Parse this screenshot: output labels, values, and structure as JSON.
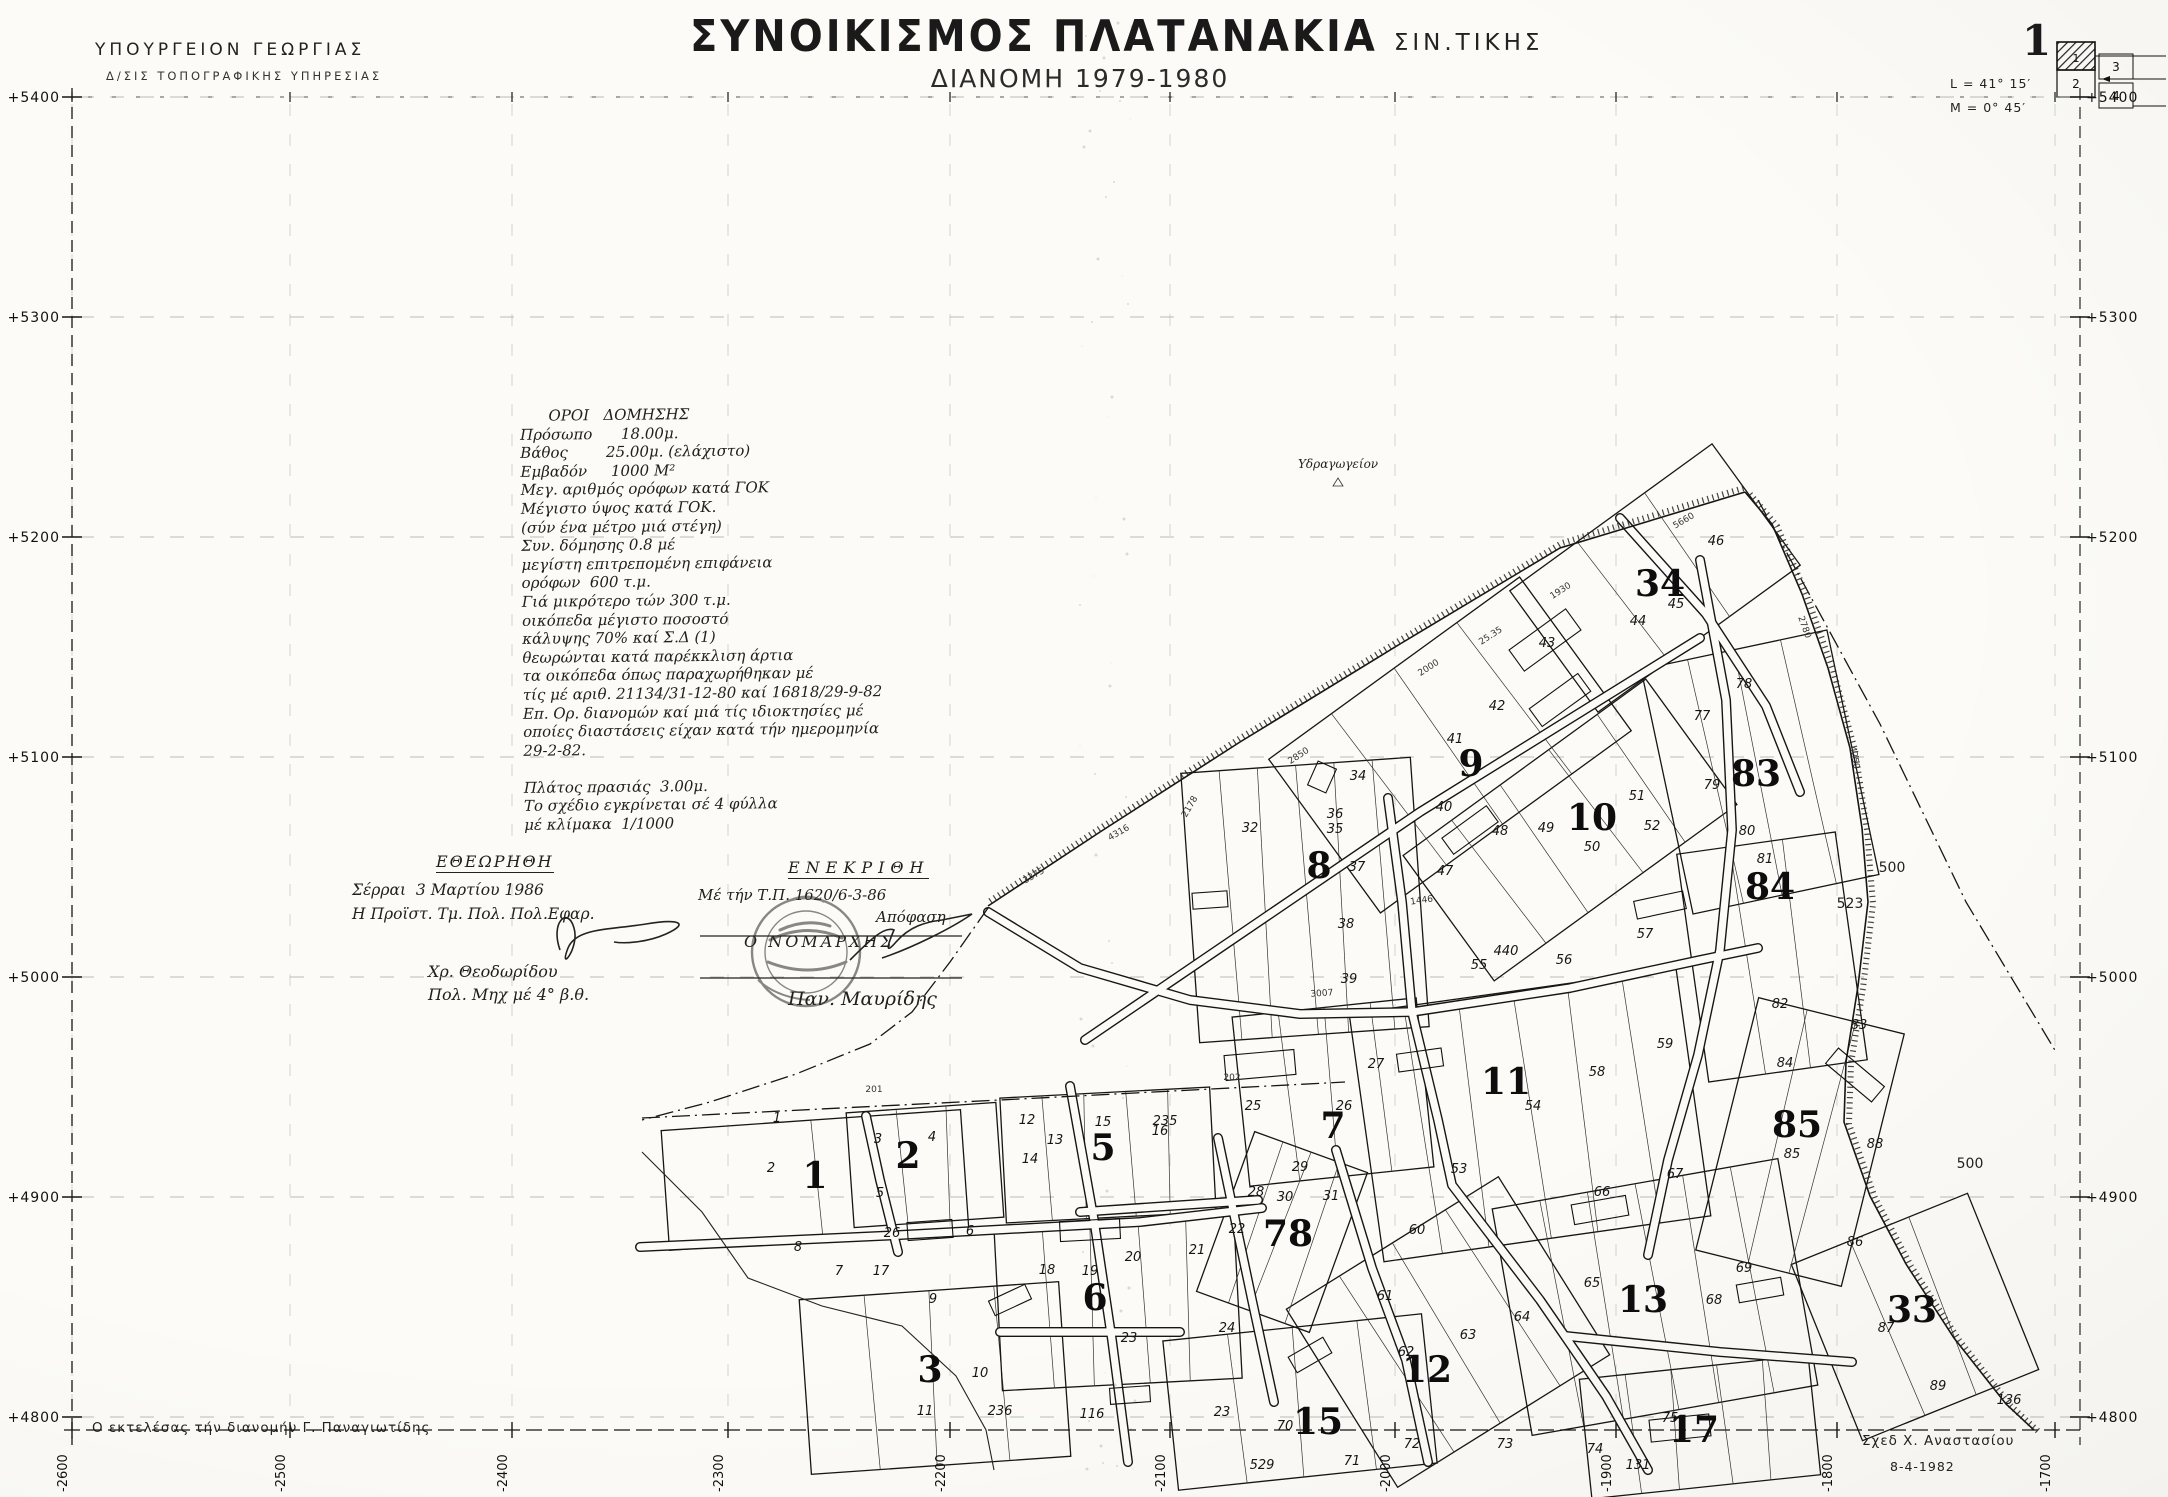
{
  "header": {
    "ministry_line1": "ΥΠΟΥΡΓΕΙΟΝ  ΓΕΩΡΓΙΑΣ",
    "ministry_line2": "Δ/ΣΙΣ  ΤΟΠΟΓΡΑΦΙΚΗΣ  ΥΠΗΡΕΣΙΑΣ",
    "title_main": "ΣΥΝΟΙΚΙΣΜΟΣ  ΠΛΑΤΑΝΑΚΙΑ",
    "title_area": "ΣΙΝ.ΤΙΚΗΣ",
    "subtitle": "ΔΙΑΝΟΜΗ  1979-1980"
  },
  "sheet_index": {
    "sheet_number": "1",
    "latitude": "L = 41° 15′",
    "meridian": "M =  0° 45′",
    "cells": [
      "1",
      "2",
      "3",
      "4"
    ]
  },
  "grid": {
    "row_labels": [
      "+5400",
      "+5300",
      "+5200",
      "+5100",
      "+5000",
      "+4900",
      "+4800"
    ],
    "col_labels": [
      "-2600",
      "-2500",
      "-2400",
      "-2300",
      "-2200",
      "-2100",
      "-2000",
      "-1900",
      "-1800",
      "-1700"
    ]
  },
  "notes": {
    "lines": [
      "      ΟΡΟΙ   ΔΟΜΗΣΗΣ",
      "Πρόσωπο      18.00μ.",
      "Βάθος        25.00μ. (ελάχιστο)",
      "Εμβαδόν     1000 Μ²",
      "Μεγ. αριθμός ορόφων κατά ΓΟΚ",
      "Μέγιστο ύψος κατά ΓΟΚ.",
      "(σύν ένα μέτρο μιά στέγη)",
      "Συν. δόμησης 0.8 μέ",
      "μεγίστη επιτρεπομένη επιφάνεια",
      "ορόφων  600 τ.μ.",
      "Γιά μικρότερο τών 300 τ.μ.",
      "οικόπεδα μέγιστο ποσοστό",
      "κάλυψης 70% καί Σ.Δ (1)",
      "θεωρώνται κατά παρέκκλιση άρτια",
      "τα οικόπεδα όπως παραχωρήθηκαν μέ",
      "τίς μέ αριθ. 21134/31-12-80 καί 16818/29-9-82",
      "Επ. Ορ. διανομών καί μιά τίς ιδιοκτησίες μέ",
      "οποίες διαστάσεις είχαν κατά τήν ημερομηνία",
      "29-2-82.",
      "",
      "Πλάτος πρασιάς  3.00μ.",
      "Το σχέδιο εγκρίνεται σέ 4 φύλλα",
      "μέ κλίμακα  1/1000"
    ]
  },
  "approval_left": {
    "title": "ΕΘΕΩΡΗΘΗ",
    "lines": [
      "Σέρραι  3 Μαρτίου 1986",
      "Η Προϊστ. Τμ. Πολ. Πολ.Εφαρ."
    ],
    "signer": "Χρ. Θεοδωρίδου",
    "signer_title": "Πολ. Μηχ μέ 4° β.θ."
  },
  "approval_right": {
    "title": "ΕΝΕΚΡΙΘΗ",
    "line1": "Μέ τήν Τ.Π. 1620/6-3-86",
    "line2": "Απόφαση",
    "line3": "Ο ΝΟΜΑΡΧΗΣ",
    "signer": "Παν. Μαυρίδης"
  },
  "footer": {
    "left": "Ο εκτελέσας  τήν  διανομήν    Γ. Παναγιωτίδης",
    "right_name": "Σχεδ     Χ. Αναστασίου",
    "right_date": "8-4-1982"
  },
  "map": {
    "place_label": {
      "text": "Υδραγωγείον",
      "x": 1298,
      "y": 468
    },
    "area_labels": [
      {
        "text": "500",
        "x": 1892,
        "y": 872
      },
      {
        "text": "500",
        "x": 1970,
        "y": 1168
      },
      {
        "text": "523",
        "x": 1850,
        "y": 908
      }
    ],
    "blocks": [
      {
        "n": "1",
        "x": 815,
        "y": 1188
      },
      {
        "n": "2",
        "x": 908,
        "y": 1168
      },
      {
        "n": "3",
        "x": 930,
        "y": 1382
      },
      {
        "n": "5",
        "x": 1103,
        "y": 1160
      },
      {
        "n": "6",
        "x": 1095,
        "y": 1310
      },
      {
        "n": "7",
        "x": 1333,
        "y": 1138
      },
      {
        "n": "8",
        "x": 1319,
        "y": 878
      },
      {
        "n": "9",
        "x": 1471,
        "y": 776
      },
      {
        "n": "10",
        "x": 1592,
        "y": 830
      },
      {
        "n": "11",
        "x": 1506,
        "y": 1094
      },
      {
        "n": "12",
        "x": 1427,
        "y": 1382
      },
      {
        "n": "13",
        "x": 1643,
        "y": 1312
      },
      {
        "n": "15",
        "x": 1318,
        "y": 1434
      },
      {
        "n": "17",
        "x": 1694,
        "y": 1442
      },
      {
        "n": "33",
        "x": 1912,
        "y": 1322
      },
      {
        "n": "34",
        "x": 1660,
        "y": 596
      },
      {
        "n": "78",
        "x": 1288,
        "y": 1246
      },
      {
        "n": "83",
        "x": 1756,
        "y": 786
      },
      {
        "n": "84",
        "x": 1770,
        "y": 899
      },
      {
        "n": "85",
        "x": 1797,
        "y": 1137
      }
    ],
    "parcels": [
      {
        "n": "46",
        "x": 1716,
        "y": 545
      },
      {
        "n": "45",
        "x": 1676,
        "y": 608
      },
      {
        "n": "44",
        "x": 1638,
        "y": 625
      },
      {
        "n": "43",
        "x": 1547,
        "y": 647
      },
      {
        "n": "42",
        "x": 1497,
        "y": 710
      },
      {
        "n": "41",
        "x": 1455,
        "y": 743
      },
      {
        "n": "40",
        "x": 1444,
        "y": 811
      },
      {
        "n": "35",
        "x": 1335,
        "y": 833
      },
      {
        "n": "34",
        "x": 1358,
        "y": 780
      },
      {
        "n": "50",
        "x": 1592,
        "y": 851
      },
      {
        "n": "51",
        "x": 1637,
        "y": 800
      },
      {
        "n": "77",
        "x": 1702,
        "y": 720
      },
      {
        "n": "78",
        "x": 1744,
        "y": 688
      },
      {
        "n": "79",
        "x": 1712,
        "y": 789
      },
      {
        "n": "80",
        "x": 1747,
        "y": 835
      },
      {
        "n": "32",
        "x": 1250,
        "y": 832
      },
      {
        "n": "36",
        "x": 1335,
        "y": 818
      },
      {
        "n": "37",
        "x": 1357,
        "y": 871
      },
      {
        "n": "38",
        "x": 1346,
        "y": 928
      },
      {
        "n": "39",
        "x": 1349,
        "y": 983
      },
      {
        "n": "47",
        "x": 1445,
        "y": 875
      },
      {
        "n": "48",
        "x": 1500,
        "y": 835
      },
      {
        "n": "49",
        "x": 1546,
        "y": 832
      },
      {
        "n": "52",
        "x": 1652,
        "y": 830
      },
      {
        "n": "55",
        "x": 1479,
        "y": 969
      },
      {
        "n": "440",
        "x": 1506,
        "y": 955
      },
      {
        "n": "56",
        "x": 1564,
        "y": 964
      },
      {
        "n": "57",
        "x": 1645,
        "y": 938
      },
      {
        "n": "58",
        "x": 1597,
        "y": 1076
      },
      {
        "n": "59",
        "x": 1665,
        "y": 1048
      },
      {
        "n": "54",
        "x": 1533,
        "y": 1110
      },
      {
        "n": "53",
        "x": 1459,
        "y": 1173
      },
      {
        "n": "25",
        "x": 1253,
        "y": 1110
      },
      {
        "n": "26",
        "x": 1344,
        "y": 1110
      },
      {
        "n": "27",
        "x": 1376,
        "y": 1068
      },
      {
        "n": "28",
        "x": 1256,
        "y": 1196
      },
      {
        "n": "29",
        "x": 1300,
        "y": 1171
      },
      {
        "n": "235",
        "x": 1165,
        "y": 1125
      },
      {
        "n": "81",
        "x": 1765,
        "y": 863
      },
      {
        "n": "82",
        "x": 1780,
        "y": 1008
      },
      {
        "n": "83",
        "x": 1859,
        "y": 1029
      },
      {
        "n": "84",
        "x": 1785,
        "y": 1067
      },
      {
        "n": "85",
        "x": 1792,
        "y": 1158
      },
      {
        "n": "88",
        "x": 1875,
        "y": 1148
      },
      {
        "n": "86",
        "x": 1855,
        "y": 1246
      },
      {
        "n": "87",
        "x": 1886,
        "y": 1332
      },
      {
        "n": "89",
        "x": 1938,
        "y": 1390
      },
      {
        "n": "136",
        "x": 2009,
        "y": 1404
      },
      {
        "n": "21",
        "x": 1197,
        "y": 1254
      },
      {
        "n": "22",
        "x": 1237,
        "y": 1233
      },
      {
        "n": "24",
        "x": 1227,
        "y": 1332
      },
      {
        "n": "23",
        "x": 1222,
        "y": 1416
      },
      {
        "n": "30",
        "x": 1285,
        "y": 1201
      },
      {
        "n": "31",
        "x": 1331,
        "y": 1200
      },
      {
        "n": "60",
        "x": 1417,
        "y": 1234
      },
      {
        "n": "61",
        "x": 1385,
        "y": 1300
      },
      {
        "n": "62",
        "x": 1406,
        "y": 1356
      },
      {
        "n": "63",
        "x": 1468,
        "y": 1339
      },
      {
        "n": "64",
        "x": 1522,
        "y": 1321
      },
      {
        "n": "65",
        "x": 1592,
        "y": 1287
      },
      {
        "n": "66",
        "x": 1602,
        "y": 1196
      },
      {
        "n": "67",
        "x": 1675,
        "y": 1178
      },
      {
        "n": "68",
        "x": 1714,
        "y": 1304
      },
      {
        "n": "69",
        "x": 1744,
        "y": 1272
      },
      {
        "n": "70",
        "x": 1285,
        "y": 1430
      },
      {
        "n": "71",
        "x": 1352,
        "y": 1465
      },
      {
        "n": "72",
        "x": 1412,
        "y": 1448
      },
      {
        "n": "73",
        "x": 1505,
        "y": 1448
      },
      {
        "n": "74",
        "x": 1595,
        "y": 1453
      },
      {
        "n": "75",
        "x": 1670,
        "y": 1422
      },
      {
        "n": "131",
        "x": 1638,
        "y": 1469
      },
      {
        "n": "529",
        "x": 1262,
        "y": 1469
      },
      {
        "n": "1",
        "x": 777,
        "y": 1122
      },
      {
        "n": "2",
        "x": 771,
        "y": 1172
      },
      {
        "n": "3",
        "x": 878,
        "y": 1143
      },
      {
        "n": "4",
        "x": 932,
        "y": 1141
      },
      {
        "n": "5",
        "x": 880,
        "y": 1197
      },
      {
        "n": "26",
        "x": 892,
        "y": 1237
      },
      {
        "n": "6",
        "x": 970,
        "y": 1235
      },
      {
        "n": "12",
        "x": 1027,
        "y": 1124
      },
      {
        "n": "13",
        "x": 1055,
        "y": 1144
      },
      {
        "n": "14",
        "x": 1030,
        "y": 1163
      },
      {
        "n": "15",
        "x": 1103,
        "y": 1126
      },
      {
        "n": "16",
        "x": 1160,
        "y": 1135
      },
      {
        "n": "17",
        "x": 881,
        "y": 1275
      },
      {
        "n": "18",
        "x": 1047,
        "y": 1274
      },
      {
        "n": "19",
        "x": 1090,
        "y": 1275
      },
      {
        "n": "20",
        "x": 1133,
        "y": 1261
      },
      {
        "n": "23",
        "x": 1129,
        "y": 1342
      },
      {
        "n": "8",
        "x": 798,
        "y": 1251
      },
      {
        "n": "7",
        "x": 839,
        "y": 1275
      },
      {
        "n": "9",
        "x": 933,
        "y": 1303
      },
      {
        "n": "10",
        "x": 980,
        "y": 1377
      },
      {
        "n": "11",
        "x": 925,
        "y": 1415
      },
      {
        "n": "236",
        "x": 1000,
        "y": 1415
      },
      {
        "n": "116",
        "x": 1092,
        "y": 1418
      }
    ],
    "dims": [
      {
        "t": "2850",
        "x": 1300,
        "y": 758,
        "r": -33
      },
      {
        "t": "2000",
        "x": 1430,
        "y": 670,
        "r": -33
      },
      {
        "t": "1930",
        "x": 1562,
        "y": 593,
        "r": -33
      },
      {
        "t": "3375",
        "x": 1035,
        "y": 878,
        "r": -30
      },
      {
        "t": "4316",
        "x": 1120,
        "y": 835,
        "r": -30
      },
      {
        "t": "5660",
        "x": 1685,
        "y": 523,
        "r": -30
      },
      {
        "t": "2780",
        "x": 1802,
        "y": 628,
        "r": 70
      },
      {
        "t": "4250",
        "x": 1852,
        "y": 758,
        "r": 80
      },
      {
        "t": "2178",
        "x": 1192,
        "y": 808,
        "r": -60
      },
      {
        "t": "1446",
        "x": 1422,
        "y": 903,
        "r": -8
      },
      {
        "t": "25.35",
        "x": 1492,
        "y": 638,
        "r": -33
      },
      {
        "t": "3007",
        "x": 1322,
        "y": 996,
        "r": -4
      },
      {
        "t": "201",
        "x": 874,
        "y": 1092,
        "r": 0
      },
      {
        "t": "202",
        "x": 1232,
        "y": 1080,
        "r": 0
      }
    ]
  }
}
